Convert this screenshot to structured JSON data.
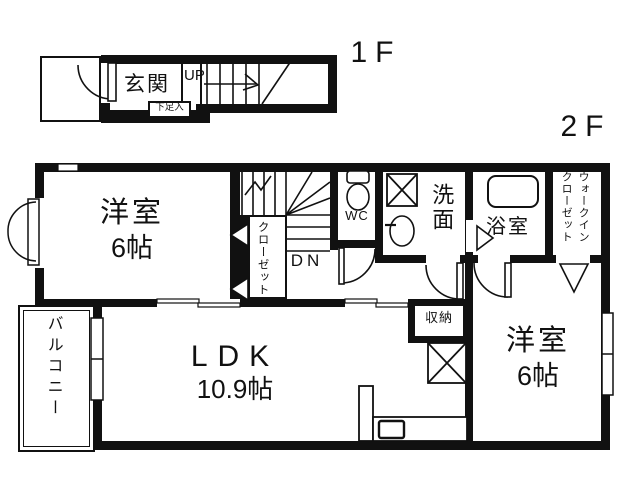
{
  "colors": {
    "line": "#111111",
    "background": "#ffffff"
  },
  "floor1": {
    "label": "1F",
    "entrance": "玄関",
    "shoe_cupboard": "下足入",
    "stairs_direction": "UP"
  },
  "floor2": {
    "label": "2F",
    "room_northwest": {
      "name": "洋室",
      "size": "6帖"
    },
    "closet": "クローゼット",
    "stairs_direction": "DN",
    "toilet": "WC",
    "washroom": "洗面",
    "bathroom": "浴室",
    "walk_in_closet": {
      "line1": "ウォークイン",
      "line2": "クローゼット"
    },
    "ldk": {
      "name": "LDK",
      "size": "10.9帖"
    },
    "room_east": {
      "name": "洋室",
      "size": "6帖"
    },
    "storage": "収納",
    "balcony": "バルコニー"
  }
}
